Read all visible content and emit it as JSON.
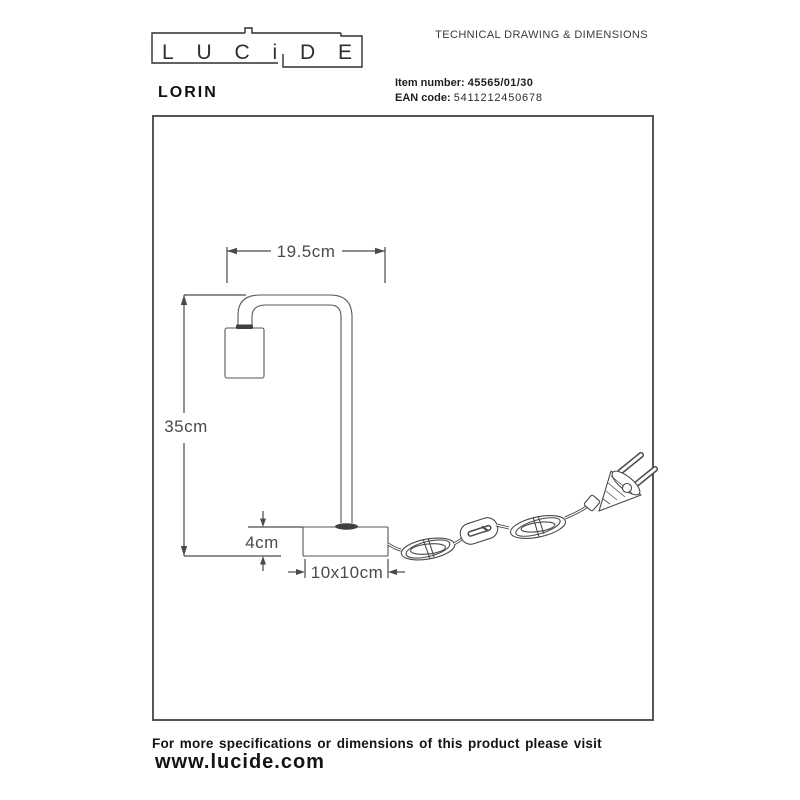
{
  "header": {
    "logo_text": "LUCiDE",
    "product_name": "LORIN",
    "doc_title": "TECHNICAL DRAWING & DIMENSIONS",
    "item_number_label": "Item number:",
    "item_number_value": "45565/01/30",
    "ean_label": "EAN code:",
    "ean_value": "5411212450678"
  },
  "drawing": {
    "dim_arm_depth": "19.5cm",
    "dim_height": "35cm",
    "dim_base_height": "4cm",
    "dim_base_size": "10x10cm",
    "line_color": "#4a4a4a"
  },
  "footer": {
    "note": "For more specifications or dimensions of this product please visit",
    "website": "www.lucide.com"
  }
}
